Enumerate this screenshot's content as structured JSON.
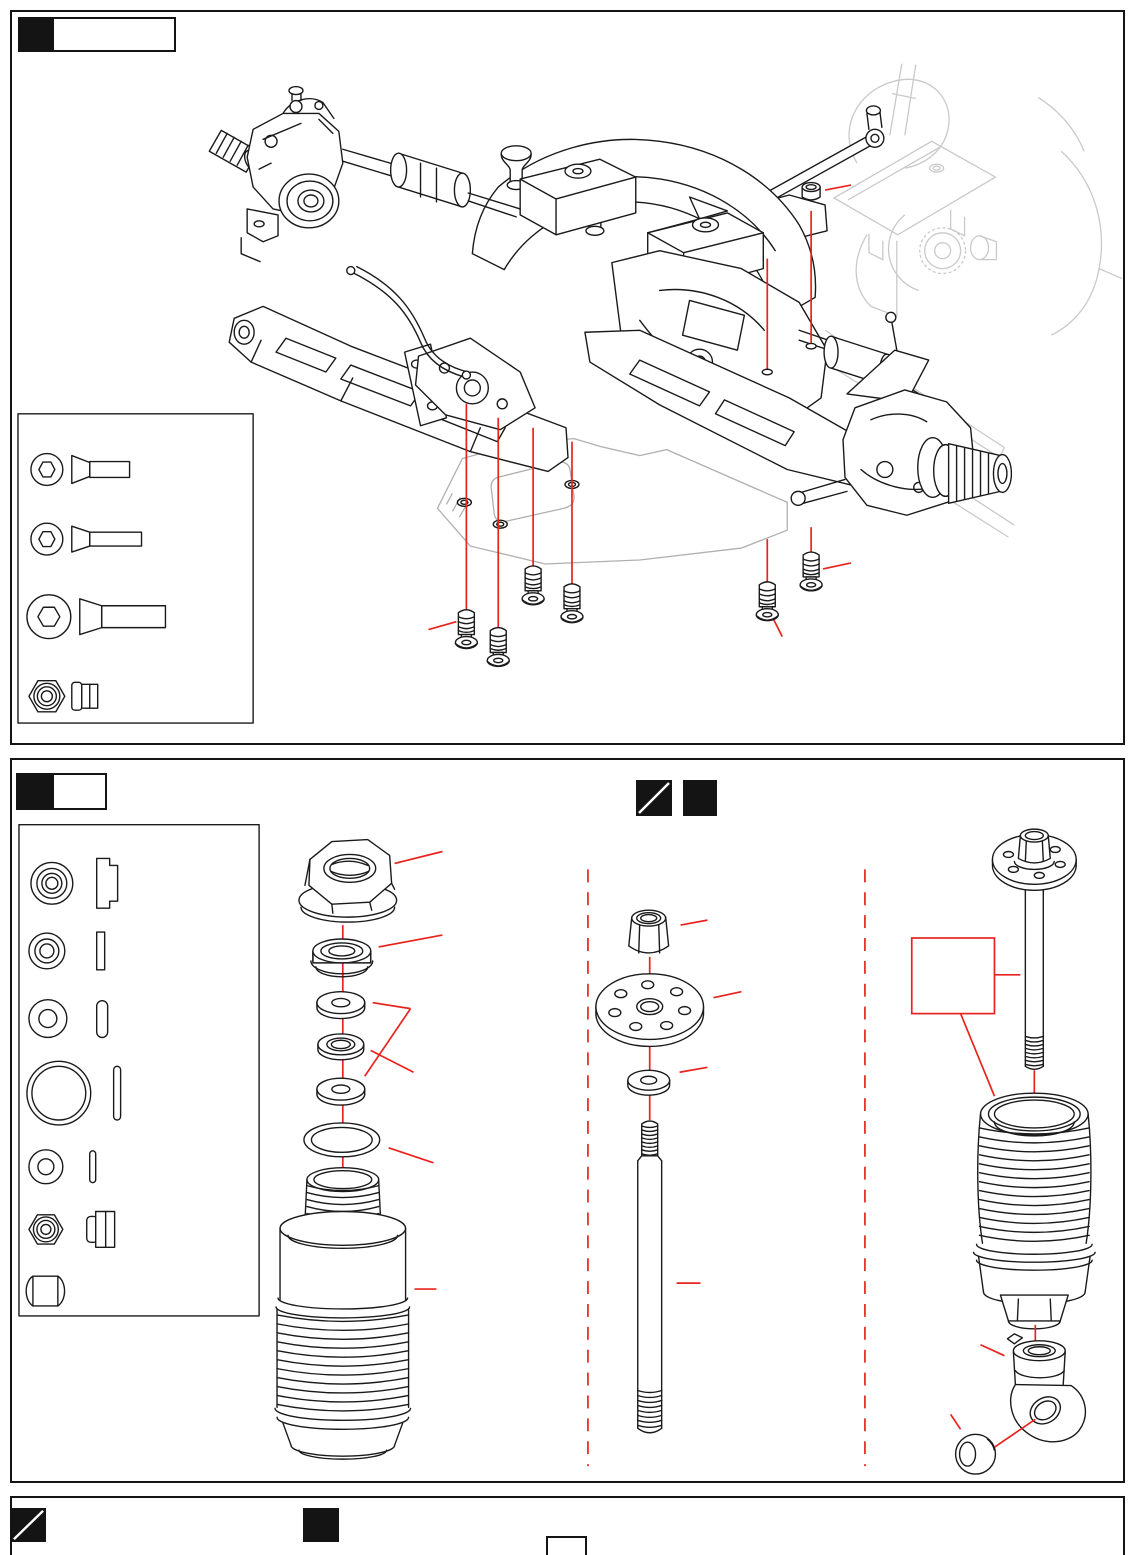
{
  "page": {
    "width": 1135,
    "height": 1555,
    "background": "#ffffff"
  },
  "colors": {
    "ink": "#1a1a1a",
    "faded_chassis": "#c9c9c9",
    "chassis_plate": "#b0b0b0",
    "accent": "#e8231d",
    "panel_border": "#141414"
  },
  "panel_top": {
    "step_tab": {
      "label": ""
    },
    "hardware_legend": {
      "items": [
        {
          "id": "flat-head-hex-screw-short",
          "views": [
            "head-front",
            "profile"
          ]
        },
        {
          "id": "flat-head-hex-screw-medium",
          "views": [
            "head-front",
            "profile"
          ]
        },
        {
          "id": "flat-head-hex-screw-long",
          "views": [
            "head-front",
            "profile"
          ]
        },
        {
          "id": "lock-nut",
          "views": [
            "front",
            "profile"
          ]
        }
      ]
    },
    "diagram": {
      "id": "rear-suspension-assembly-exploded-view",
      "callout_labels": [
        "",
        "",
        "",
        "",
        "",
        "",
        "",
        "",
        ""
      ]
    }
  },
  "panel_bottom": {
    "step_tab": {
      "label": ""
    },
    "markers": [
      {
        "id": "diagonal-split-square-marker"
      },
      {
        "id": "filled-square-marker"
      }
    ],
    "parts_legend": {
      "items": [
        {
          "id": "shock-bushing-large",
          "views": [
            "front",
            "profile"
          ]
        },
        {
          "id": "shock-seal-washer",
          "views": [
            "front",
            "profile"
          ]
        },
        {
          "id": "shock-spacer",
          "views": [
            "front",
            "profile"
          ]
        },
        {
          "id": "o-ring-large",
          "views": [
            "front",
            "profile"
          ]
        },
        {
          "id": "washer-small",
          "views": [
            "front",
            "profile"
          ]
        },
        {
          "id": "lock-nut",
          "views": [
            "front",
            "profile"
          ]
        },
        {
          "id": "pivot-ball",
          "views": [
            "front"
          ]
        }
      ]
    },
    "columns": [
      {
        "id": "shock-cap-seal-stack-and-body",
        "callout_labels": [
          "",
          "",
          "",
          "",
          ""
        ]
      },
      {
        "id": "shock-piston-nut-washer-shaft",
        "callout_labels": [
          "",
          "",
          "",
          ""
        ]
      },
      {
        "id": "shock-assembly-rod-end-and-ball",
        "note_box_label": "",
        "callout_labels": [
          "",
          "",
          ""
        ]
      }
    ]
  },
  "panel_footer": {
    "markers": [
      {
        "id": "diagonal-split-square-marker"
      },
      {
        "id": "filled-square-marker"
      }
    ],
    "page_tab_label": ""
  }
}
